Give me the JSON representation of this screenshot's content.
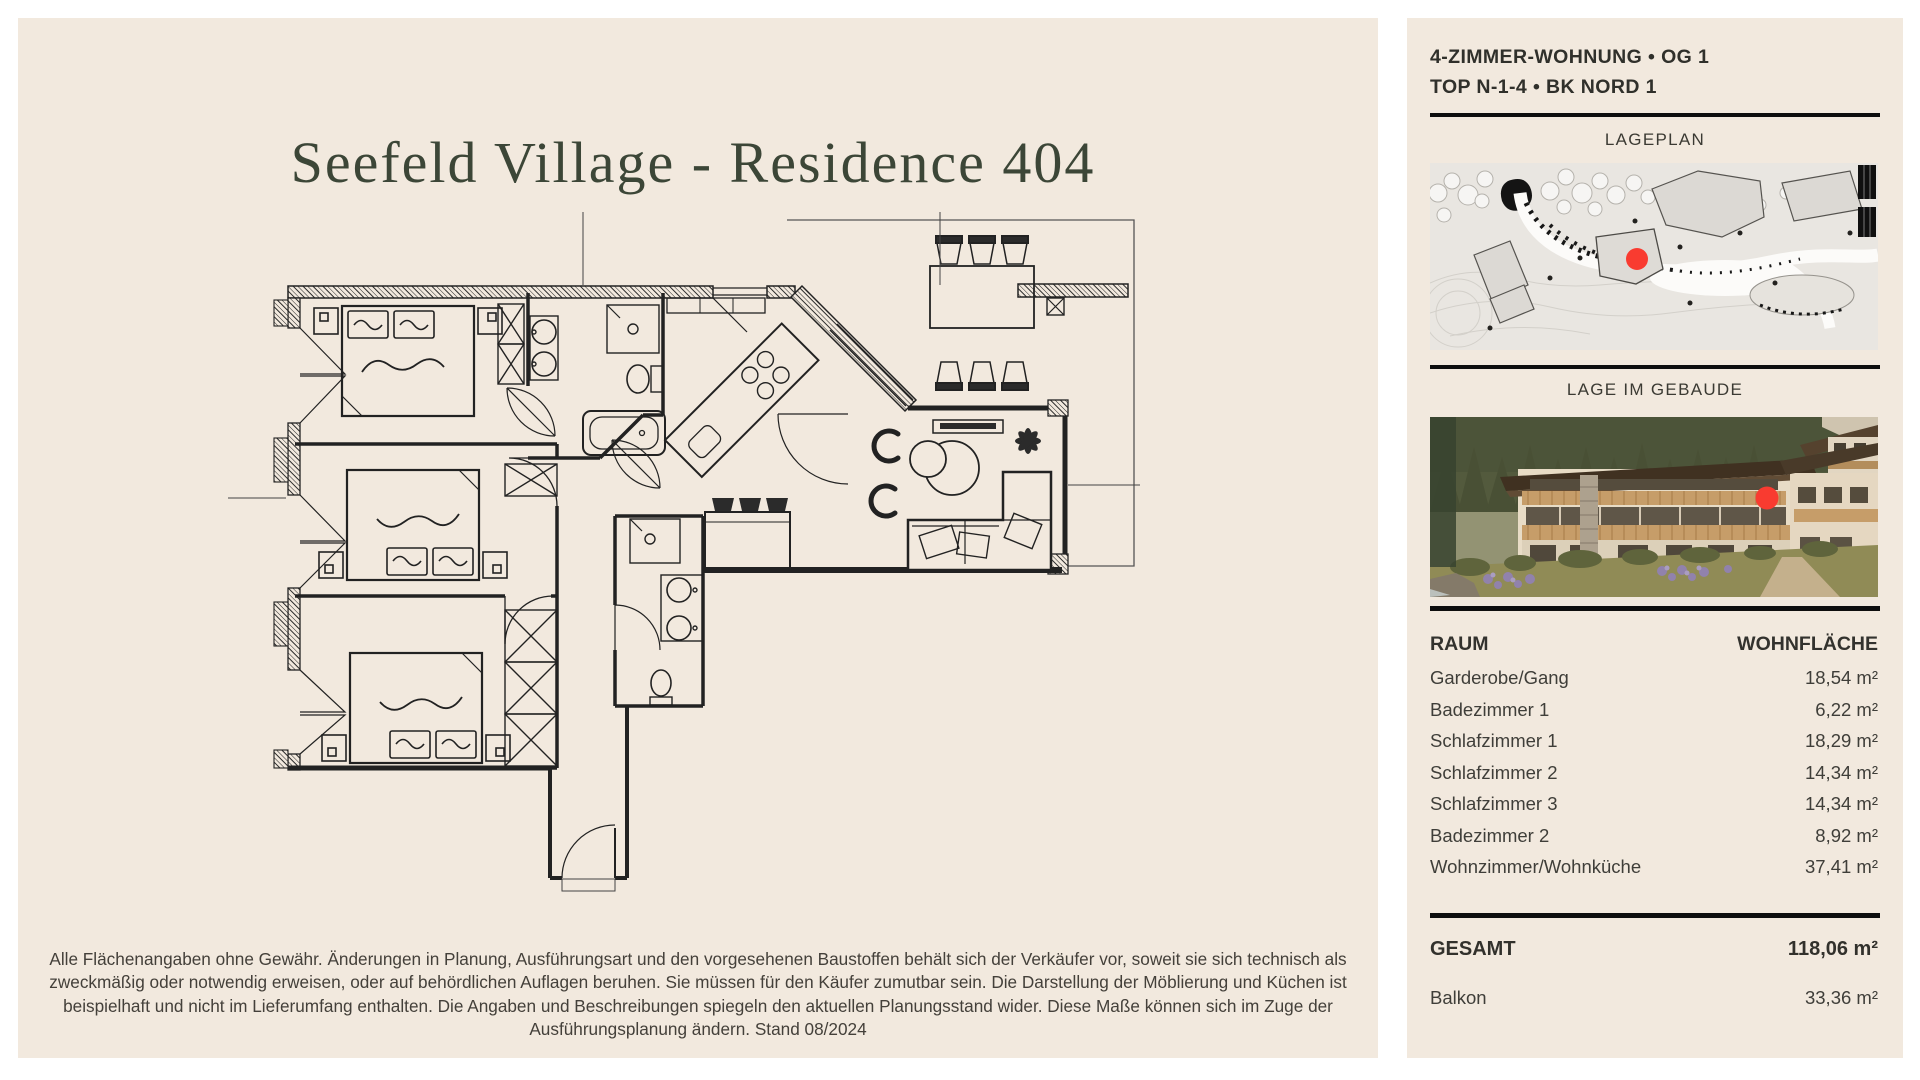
{
  "colors": {
    "page_bg": "#ffffff",
    "panel_bg": "#f2e9de",
    "title_green": "#3c4637",
    "rule_black": "#0e0e0e",
    "marker_red": "#f93b30",
    "plan_line": "#222222"
  },
  "left_panel": {
    "title": "Seefeld Village - Residence 404",
    "disclaimer_lines": [
      "Alle Flächenangaben ohne Gewähr. Änderungen in Planung, Ausführungsart und den vorgesehenen Baustoffen behält sich der Verkäufer vor, soweit sie sich technisch als",
      "zweckmäßig oder notwendig erweisen, oder auf behördlichen Auflagen beruhen. Sie müssen für den Käufer zumutbar sein. Die Darstellung der Möblierung und Küchen ist",
      "beispielhaft und nicht im Lieferumfang enthalten. Die Angaben und Beschreibungen spiegeln den aktuellen Planungsstand wider. Diese Maße können sich im Zuge der",
      "Ausführungsplanung ändern. Stand 08/2024"
    ]
  },
  "sidebar": {
    "header_line1": "4-ZIMMER-WOHNUNG • OG 1",
    "header_line2": "TOP N-1-4 • BK NORD 1",
    "lageplan_title": "LAGEPLAN",
    "gebaeude_title": "LAGE IM GEBAUDE",
    "table": {
      "col_room": "RAUM",
      "col_area": "WOHNFLÄCHE",
      "rows": [
        {
          "room": "Garderobe/Gang",
          "area": "18,54 m²"
        },
        {
          "room": "Badezimmer 1",
          "area": "6,22 m²"
        },
        {
          "room": "Schlafzimmer 1",
          "area": "18,29 m²"
        },
        {
          "room": "Schlafzimmer 2",
          "area": "14,34 m²"
        },
        {
          "room": "Schlafzimmer 3",
          "area": "14,34 m²"
        },
        {
          "room": "Badezimmer 2",
          "area": "8,92 m²"
        },
        {
          "room": "Wohnzimmer/Wohnküche",
          "area": "37,41 m²"
        }
      ],
      "total_label": "GESAMT",
      "total_area": "118,06 m²",
      "balcony_label": "Balkon",
      "balcony_area": "33,36 m²"
    }
  }
}
